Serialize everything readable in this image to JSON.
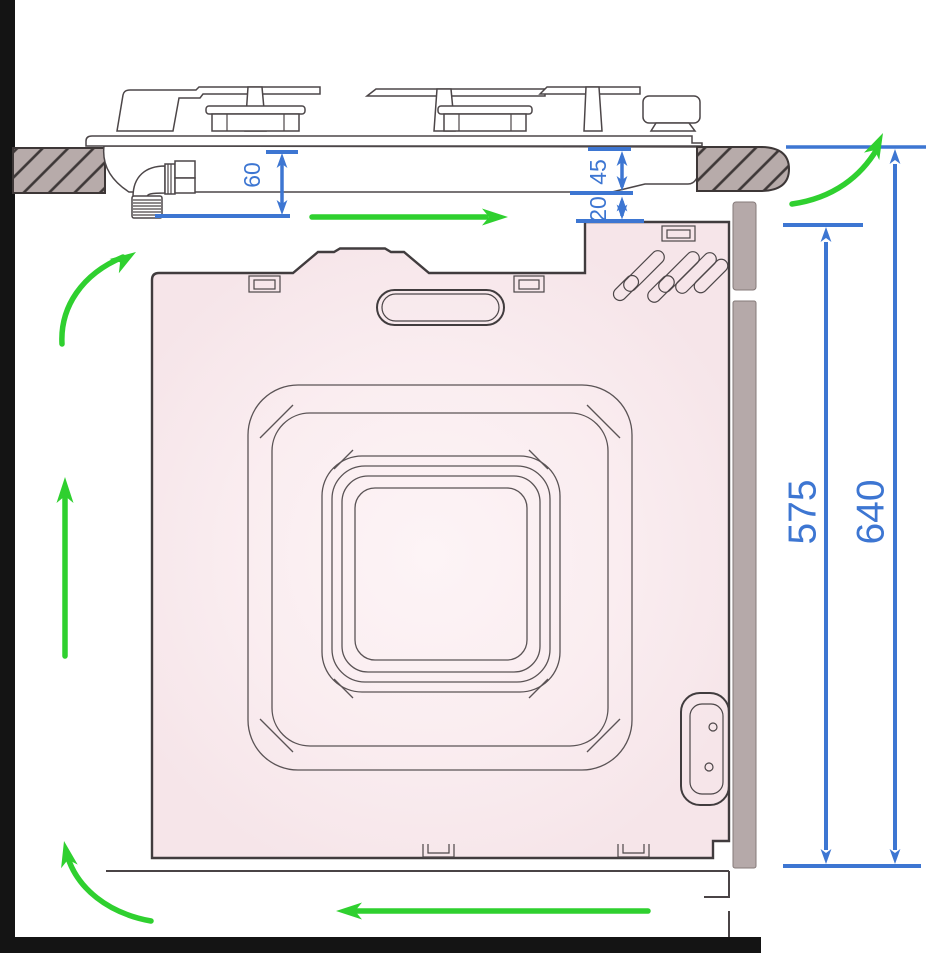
{
  "diagram": {
    "kind": "appliance-installation-section",
    "subject": "Built-in oven beneath gas hob with ventilation clearances",
    "units_implied": "mm"
  },
  "dimension_labels": {
    "hob_depth": "60",
    "worktop_to_hob_clearance": "45",
    "hob_to_oven_gap": "20",
    "oven_height": "575",
    "niche_overall_height": "640"
  },
  "colors": {
    "dimension_blue": "#3d76d2",
    "airflow_green": "#2fd02f",
    "oven_fill_pink": "#f8e8ec",
    "worktop_fill": "#b7abaa",
    "outline_dark": "#413c3e",
    "wall_floor_black": "#141414"
  },
  "airflow_arrows": [
    "air-in-under-oven-left",
    "air-up-left-wall",
    "air-curve-into-hob-recess",
    "air-right-under-hob",
    "air-curve-up-behind-worktop",
    "air-out-left-under-plinth"
  ]
}
